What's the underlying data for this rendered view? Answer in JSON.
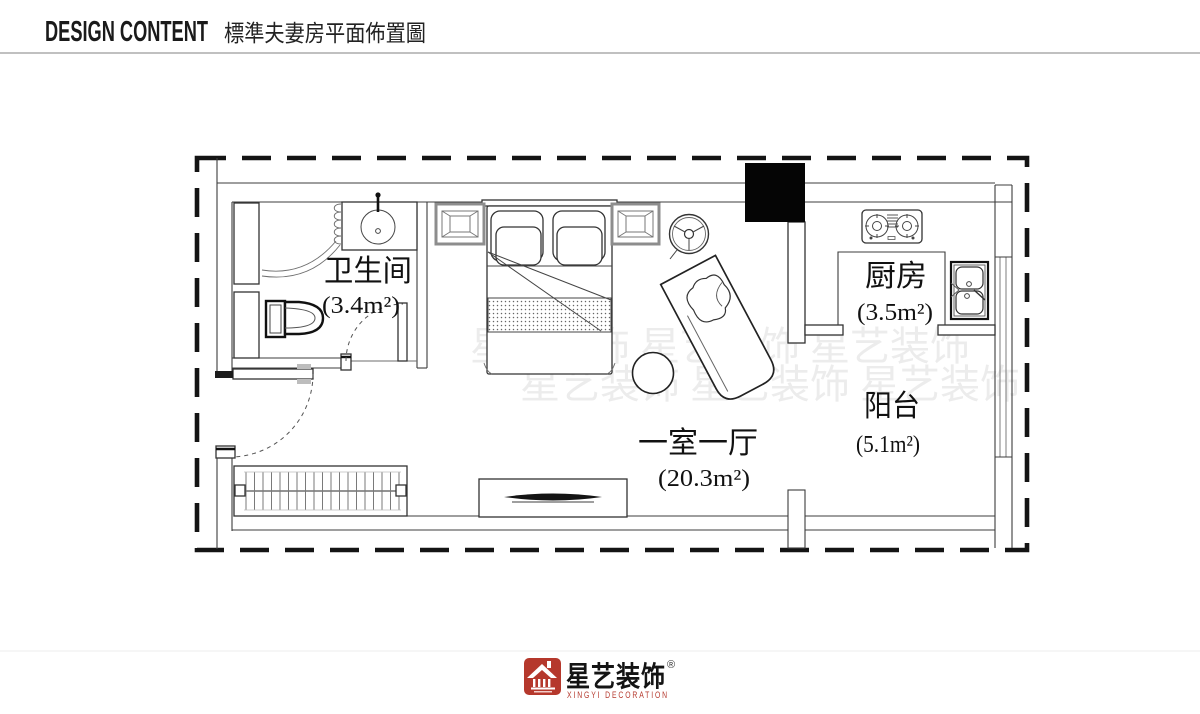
{
  "header": {
    "title_en": "DESIGN CONTENT",
    "title_zh": "標準夫妻房平面佈置圖"
  },
  "plan": {
    "rooms": {
      "bathroom": {
        "name": "卫生间",
        "area": "(3.4m²)"
      },
      "kitchen": {
        "name": "厨房",
        "area": "(3.5m²)"
      },
      "living": {
        "name": "一室一厅",
        "area": "(20.3m²)"
      },
      "balcony": {
        "name": "阳台",
        "area": "(5.1m²)"
      }
    },
    "watermark": "星艺装饰 星艺装饰 星艺装饰"
  },
  "footer": {
    "brand_zh": "星艺装饰",
    "registered": "®",
    "brand_en": "XINGYI DECORATION",
    "accent_color": "#b5382c"
  }
}
